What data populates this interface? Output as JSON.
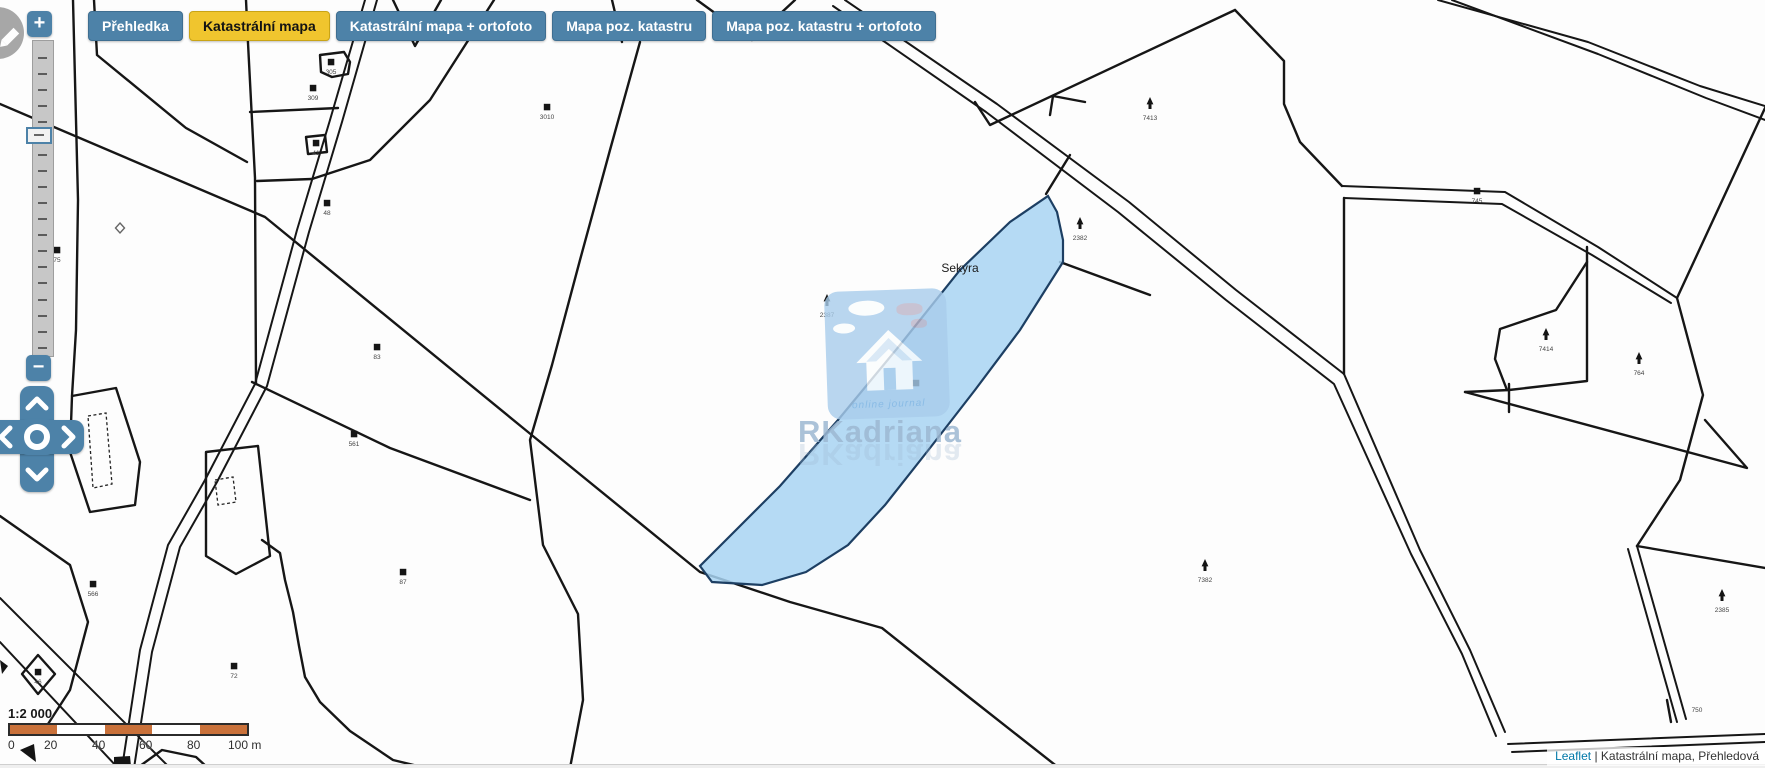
{
  "toolbar": {
    "tabs": [
      {
        "label": "Přehledka",
        "active": false
      },
      {
        "label": "Katastrální mapa",
        "active": true
      },
      {
        "label": "Katastrální mapa + ortofoto",
        "active": false
      },
      {
        "label": "Mapa poz. katastru",
        "active": false
      },
      {
        "label": "Mapa poz. katastru + ortofoto",
        "active": false
      }
    ]
  },
  "controls": {
    "zoom_in": "+",
    "zoom_out": "−"
  },
  "watermark": {
    "tagline": "online journal",
    "brand": "RKadriana"
  },
  "scale": {
    "ratio": "1:2 000",
    "labels": [
      {
        "text": "0",
        "x": 0
      },
      {
        "text": "20",
        "x": 36
      },
      {
        "text": "40",
        "x": 84
      },
      {
        "text": "60",
        "x": 131
      },
      {
        "text": "80",
        "x": 179
      },
      {
        "text": "100 m",
        "x": 220
      }
    ],
    "segments": [
      "#c9713a",
      "#ffffff",
      "#c9713a",
      "#ffffff",
      "#c9713a"
    ]
  },
  "attribution": {
    "link": "Leaflet",
    "rest": " | Katastrální mapa, Přehledová"
  },
  "colors": {
    "accent": "#4d82a8",
    "active_tab": "#f0c52e",
    "parcel_fill": "#a8d3f2",
    "parcel_stroke": "#1d3f63",
    "scale_orange": "#c9713a",
    "link": "#0078a8",
    "line": "#161616"
  },
  "map": {
    "place_label": {
      "text": "Sekyra",
      "x": 960,
      "y": 272
    },
    "blue_parcel": "M1048,196 L1057,212 L1063,240 L1063,262 L1020,330 L975,390 L930,448 L885,505 L848,545 L806,572 L762,585 L712,582 L700,566 L726,540 L780,486 L838,420 L900,345 L960,270 L1010,222 Z",
    "roads": [
      "M365,0 L330,120 L297,230 L255,384 L205,480 L168,545 L140,650 L122,768",
      "M377,0 L342,122 L309,232 L267,386 L217,482 L180,547 L152,652 L134,768",
      "M845,0 L997,104 L1129,202 L1236,290 L1344,374 L1420,550 L1470,650 L1505,732",
      "M833,6 L986,112 L1118,212 L1226,300 L1334,384 L1411,554 L1462,654 L1496,736",
      "M1438,0 L1588,42 L1700,86 L1765,106",
      "M1452,0 L1598,54 L1706,98 L1765,120",
      "M0,598 L170,768",
      "M0,642 L118,768",
      "M1508,744 L1765,734",
      "M1512,752 L1765,742",
      "M1342,186 L1505,192 L1598,247 L1677,298",
      "M1344,198 L1502,204 L1592,255 L1671,303",
      "M1628,549 L1677,722",
      "M1637,546 L1686,719"
    ],
    "boundaries": [
      "M0,104 L265,217 L528,432 L700,572 L790,602 L882,628 L970,698 L1059,768",
      "M640,42 L610,150 L580,260 L552,365 L530,440 L543,545 L578,614 L583,700 L570,768",
      "M612,0 L622,42",
      "M697,0 L752,40 L795,0",
      "M975,102 L990,125 L1235,10",
      "M1235,10 L1284,61 L1284,104 L1300,142 L1342,186",
      "M1344,198 L1344,374",
      "M1765,108 L1677,298 L1703,395 L1680,480 L1637,546",
      "M1637,546 L1765,568",
      "M1587,247 L1587,381 L1509,390 L1465,392",
      "M1587,262 L1556,310 L1500,329 L1495,359 L1507,390",
      "M1509,384 L1509,412",
      "M1465,392 L1747,468 L1705,420",
      "M246,0 L248,43 L255,178 L256,384",
      "M250,112 L338,108",
      "M494,0 L430,100 L370,160 L312,179 L257,181",
      "M393,0 L415,46 L441,0",
      "M73,0 L78,200 L76,330 L72,396",
      "M94,0 L97,55 L186,128 L247,162",
      "M0,436 L68,452",
      "M0,516 L70,565 L88,622 L70,690 L48,724",
      "M262,540 L280,553 L285,580 L293,612 L299,646 L305,677 L320,702 L350,731 L393,760 L426,768",
      "M252,382 L390,448 L530,500",
      "M1046,194 L1070,155",
      "M1060,262 L1150,295",
      "M1050,115 L1053,96 L1085,102",
      "M320,55 L344,52 L350,62 L348,74 L332,77 L321,72 Z",
      "M306,137 L325,135 L327,152 L308,154 Z",
      "M72,396 L116,388 L140,462 L135,505 L90,512 L70,452 Z",
      "M206,452 L258,446 L270,556 L236,574 L206,556 Z",
      "M38,655 L55,674 L38,694 L22,674 Z",
      "M140,766 L162,750 L196,757 L208,768",
      "M1671,722 L1667,700"
    ],
    "dashed_shapes": [
      "M88,416 L106,413 L112,484 L93,488 Z",
      "M215,480 L233,477 L236,502 L218,505 Z"
    ],
    "solid_shapes": [
      "M20,750 L34,744 L36,762 Z",
      "M0,660 L8,666 L2,674 Z",
      "M114,757 L130,756 L131,766 L114,767 Z"
    ],
    "dots": [
      {
        "x": 331,
        "y": 62,
        "n": "305"
      },
      {
        "x": 313,
        "y": 88,
        "n": "309"
      },
      {
        "x": 316,
        "y": 143,
        "n": "41"
      },
      {
        "x": 547,
        "y": 107,
        "n": "3010"
      },
      {
        "x": 327,
        "y": 203,
        "n": "48"
      },
      {
        "x": 377,
        "y": 347,
        "n": "83"
      },
      {
        "x": 354,
        "y": 434,
        "n": "561"
      },
      {
        "x": 403,
        "y": 572,
        "n": "87"
      },
      {
        "x": 93,
        "y": 584,
        "n": "566"
      },
      {
        "x": 234,
        "y": 666,
        "n": "72"
      },
      {
        "x": 57,
        "y": 250,
        "n": "75"
      },
      {
        "x": 38,
        "y": 672,
        "n": "46"
      },
      {
        "x": 916,
        "y": 383,
        "n": ""
      },
      {
        "x": 1477,
        "y": 191,
        "n": "745"
      }
    ],
    "trees": [
      {
        "x": 827,
        "y": 305,
        "n": "2387"
      },
      {
        "x": 1080,
        "y": 228,
        "n": "2382"
      },
      {
        "x": 1150,
        "y": 108,
        "n": "7413"
      },
      {
        "x": 1546,
        "y": 339,
        "n": "7414"
      },
      {
        "x": 1639,
        "y": 363,
        "n": "764"
      },
      {
        "x": 1205,
        "y": 570,
        "n": "7382"
      },
      {
        "x": 1722,
        "y": 600,
        "n": "2385"
      }
    ],
    "hollow_diamonds": [
      {
        "x": 120,
        "y": 228
      }
    ],
    "small_labels": [
      {
        "x": 1697,
        "y": 712,
        "t": "750"
      }
    ]
  }
}
